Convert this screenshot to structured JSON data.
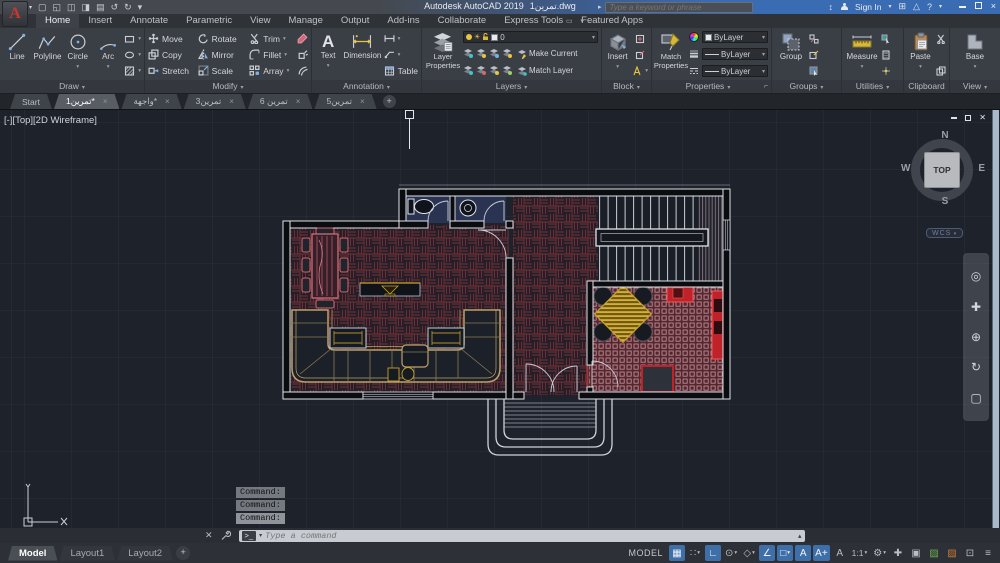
{
  "title_bar": {
    "logo_letter": "A",
    "app_title": "Autodesk AutoCAD 2019",
    "doc_name": "تمرين1.dwg",
    "search_placeholder": "Type a keyword or phrase",
    "sign_in_label": "Sign In",
    "qat": [
      {
        "name": "new-file-icon",
        "glyph": "▢"
      },
      {
        "name": "open-file-icon",
        "glyph": "◱"
      },
      {
        "name": "save-icon",
        "glyph": "◫"
      },
      {
        "name": "save-as-icon",
        "glyph": "◨"
      },
      {
        "name": "plot-icon",
        "glyph": "▤"
      },
      {
        "name": "undo-icon",
        "glyph": "↺"
      },
      {
        "name": "redo-icon",
        "glyph": "↻"
      },
      {
        "name": "qat-customize-icon",
        "glyph": "▾"
      }
    ]
  },
  "ribbon": {
    "tabs": [
      {
        "label": "Home",
        "active": true
      },
      {
        "label": "Insert"
      },
      {
        "label": "Annotate"
      },
      {
        "label": "Parametric"
      },
      {
        "label": "View"
      },
      {
        "label": "Manage"
      },
      {
        "label": "Output"
      },
      {
        "label": "Add-ins"
      },
      {
        "label": "Collaborate"
      },
      {
        "label": "Express Tools"
      },
      {
        "label": "Featured Apps"
      }
    ],
    "panels": {
      "draw": {
        "label": "Draw",
        "tools": [
          "Line",
          "Polyline",
          "Circle",
          "Arc"
        ]
      },
      "modify": {
        "label": "Modify",
        "tools": [
          "Move",
          "Copy",
          "Stretch",
          "Rotate",
          "Mirror",
          "Scale",
          "Trim",
          "Fillet",
          "Array"
        ]
      },
      "annotation": {
        "label": "Annotation",
        "text": "Text",
        "dimension": "Dimension",
        "table": "Table"
      },
      "layers": {
        "label": "Layers",
        "layer_properties": "Layer Properties",
        "current_layer": "0",
        "make_current": "Make Current",
        "match_layer": "Match Layer"
      },
      "block": {
        "label": "Block",
        "insert": "Insert"
      },
      "properties": {
        "label": "Properties",
        "match_properties": "Match Properties",
        "color_value": "ByLayer",
        "lineweight_value": "ByLayer",
        "linetype_value": "ByLayer"
      },
      "groups": {
        "label": "Groups",
        "group": "Group"
      },
      "utilities": {
        "label": "Utilities",
        "measure": "Measure"
      },
      "clipboard": {
        "label": "Clipboard",
        "paste": "Paste"
      },
      "view": {
        "label": "View",
        "base": "Base"
      }
    }
  },
  "file_tabs": {
    "tabs": [
      {
        "label": "Start",
        "active": false,
        "closable": false
      },
      {
        "label": "تمرين1*",
        "active": true,
        "closable": true
      },
      {
        "label": "واجهة*",
        "active": false,
        "closable": true
      },
      {
        "label": "تمرين3",
        "active": false,
        "closable": true
      },
      {
        "label": "تمرين 6",
        "active": false,
        "closable": true
      },
      {
        "label": "تمرين5",
        "active": false,
        "closable": true
      }
    ],
    "new_tab_label": "+"
  },
  "viewport": {
    "label": "[-][Top][2D Wireframe]",
    "viewcube": {
      "n": "N",
      "s": "S",
      "e": "E",
      "w": "W",
      "top": "TOP",
      "wcs": "WCS"
    },
    "ucs": {
      "x": "X",
      "y": "Y"
    },
    "nav_icons": [
      {
        "name": "navigation-wheel-icon",
        "glyph": "◎"
      },
      {
        "name": "pan-icon",
        "glyph": "✚"
      },
      {
        "name": "zoom-icon",
        "glyph": "⊕"
      },
      {
        "name": "orbit-icon",
        "glyph": "↻"
      },
      {
        "name": "show-motion-icon",
        "glyph": "▢"
      }
    ]
  },
  "command_line": {
    "history": [
      "Command:",
      "Command:",
      "Command:"
    ],
    "placeholder": "Type a command"
  },
  "status_bar": {
    "layout_tabs": [
      {
        "label": "Model",
        "active": true
      },
      {
        "label": "Layout1",
        "active": false
      },
      {
        "label": "Layout2",
        "active": false
      }
    ],
    "new_layout_label": "+",
    "model_label": "MODEL",
    "icons": [
      {
        "name": "grid-display-icon",
        "glyph": "▦",
        "active": true
      },
      {
        "name": "snap-mode-icon",
        "glyph": "∷",
        "active": false,
        "dd": true
      },
      {
        "name": "ortho-mode-icon",
        "glyph": "∟",
        "active": true
      },
      {
        "name": "polar-tracking-icon",
        "glyph": "⊙",
        "active": false,
        "dd": true
      },
      {
        "name": "isometric-drafting-icon",
        "glyph": "◇",
        "active": false,
        "dd": true
      },
      {
        "name": "object-snap-tracking-icon",
        "glyph": "∠",
        "active": true
      },
      {
        "name": "object-snap-icon",
        "glyph": "□",
        "active": true,
        "dd": true
      },
      {
        "name": "annotation-visibility-icon",
        "glyph": "A",
        "active": true
      },
      {
        "name": "annotation-autoscale-icon",
        "glyph": "A+",
        "active": true
      },
      {
        "name": "annotation-scale-icon",
        "glyph": "A",
        "active": false
      },
      {
        "name": "annotation-scale-value",
        "label": "1:1",
        "active": false,
        "dd": true
      },
      {
        "name": "workspace-icon",
        "glyph": "⚙",
        "active": false,
        "dd": true
      },
      {
        "name": "crosshair-toggle-icon",
        "glyph": "✚",
        "active": false
      },
      {
        "name": "isolate-objects-icon",
        "glyph": "▣",
        "active": false
      },
      {
        "name": "graphics-performance-icon",
        "glyph": "▨",
        "active": false,
        "color": "#6fae4e"
      },
      {
        "name": "hardware-accel-icon",
        "glyph": "▨",
        "active": false,
        "color": "#c87a3a"
      },
      {
        "name": "clean-screen-icon",
        "glyph": "⊡",
        "active": false
      },
      {
        "name": "customize-icon",
        "glyph": "≡",
        "active": false
      }
    ]
  },
  "colors": {
    "accent_blue": "#7fb3e8",
    "selection_red": "#c02730",
    "parquet_red": "#77303a",
    "sofa_tan": "#bfa06a",
    "table_pink": "#e0707a",
    "gold": "#c9a227",
    "wall_white": "#dfe3e8"
  }
}
